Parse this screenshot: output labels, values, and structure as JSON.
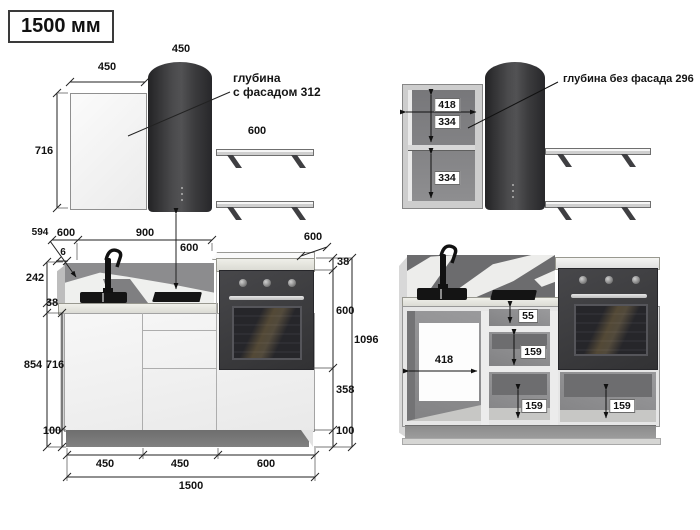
{
  "title": "1500 мм",
  "left_view": {
    "annotation": {
      "line1": "глубина",
      "line2": "с фасадом 312"
    },
    "dims": {
      "panel_width": "450",
      "hood_width": "450",
      "panel_height": "716",
      "shelf_width": "600",
      "worktop_depth_label": "594",
      "worktop_depth": "600",
      "overhang": "6",
      "hob_span": "900",
      "hood_clearance": "600",
      "splash_height": "242",
      "worktop_thickness": "38",
      "base_height_total": "854",
      "carcass_height": "716",
      "plinth_height": "100",
      "tower_top_depth": "600",
      "tower_top_thickness": "38",
      "oven_height": "600",
      "tower_height": "1096",
      "tower_drawer": "358",
      "tower_plinth": "100",
      "bottom_seg1": "450",
      "bottom_seg2": "450",
      "bottom_seg3": "600",
      "total_width": "1500"
    }
  },
  "right_view": {
    "annotation": "глубина без фасада 296",
    "dims": {
      "wall_cabinet_width": "418",
      "wall_gap_top": "334",
      "wall_gap_bottom": "334",
      "drawer_top": "55",
      "drawer_mid": "159",
      "base_opening_width": "418",
      "drawer_bottom": "159",
      "oven_drawer": "159"
    }
  }
}
